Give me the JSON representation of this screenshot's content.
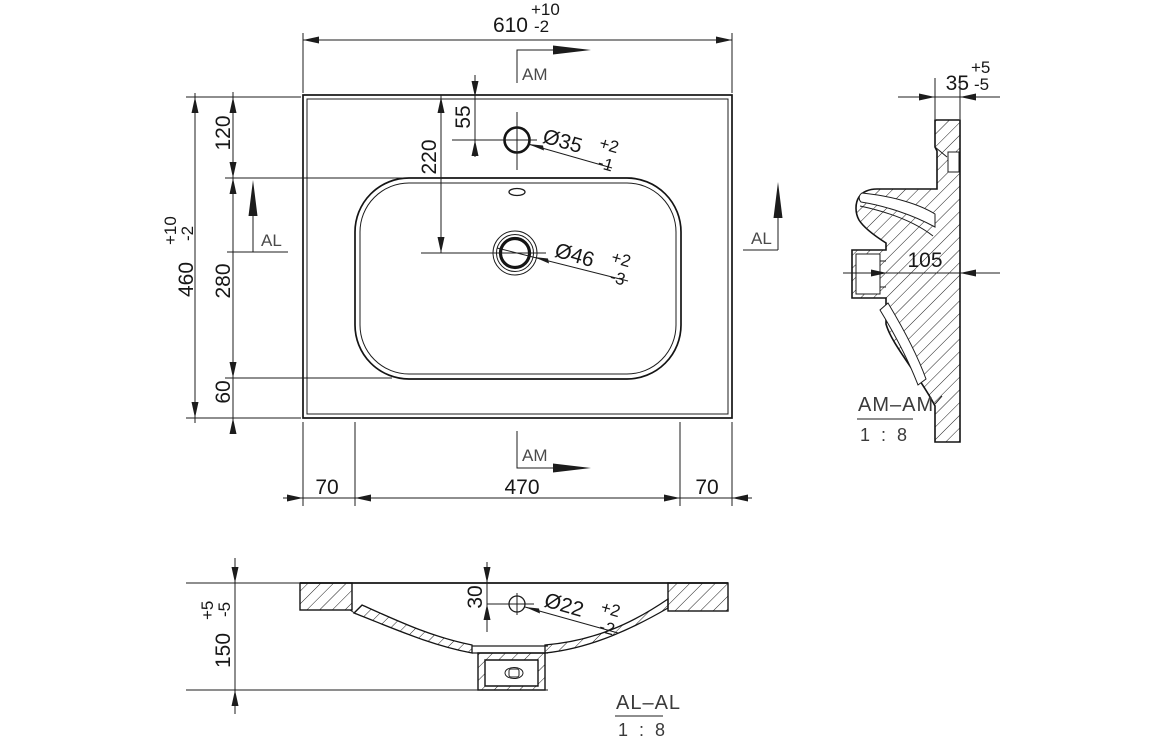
{
  "drawing_type": "washbasin technical drawing, plan view with two section views",
  "plan": {
    "width": {
      "value": "610",
      "plus": "+10",
      "minus": "-2"
    },
    "height": {
      "value": "460",
      "plus": "+10",
      "minus": "-2"
    },
    "left_chain": {
      "top": "120",
      "middle": "280",
      "bottom": "60"
    },
    "bottom_chain": {
      "left": "70",
      "center": "470",
      "right": "70"
    },
    "faucet_offset": "55",
    "drain_offset": "220",
    "faucet_hole": {
      "label": "Ø35",
      "plus": "+2",
      "minus": "-1"
    },
    "drain_hole": {
      "label": "Ø46",
      "plus": "+2",
      "minus": "-3"
    },
    "cut_am": "AM",
    "cut_al": "AL"
  },
  "section_am": {
    "title": "AM–AM",
    "scale": "1 : 8",
    "rim_width": {
      "value": "35",
      "plus": "+5",
      "minus": "-5"
    },
    "depth": "105"
  },
  "section_al": {
    "title": "AL–AL",
    "scale": "1 : 8",
    "height": {
      "value": "150",
      "plus": "+5",
      "minus": "-5"
    },
    "overflow_offset": "30",
    "overflow_hole": {
      "label": "Ø22",
      "plus": "+2",
      "minus": "-2"
    }
  }
}
